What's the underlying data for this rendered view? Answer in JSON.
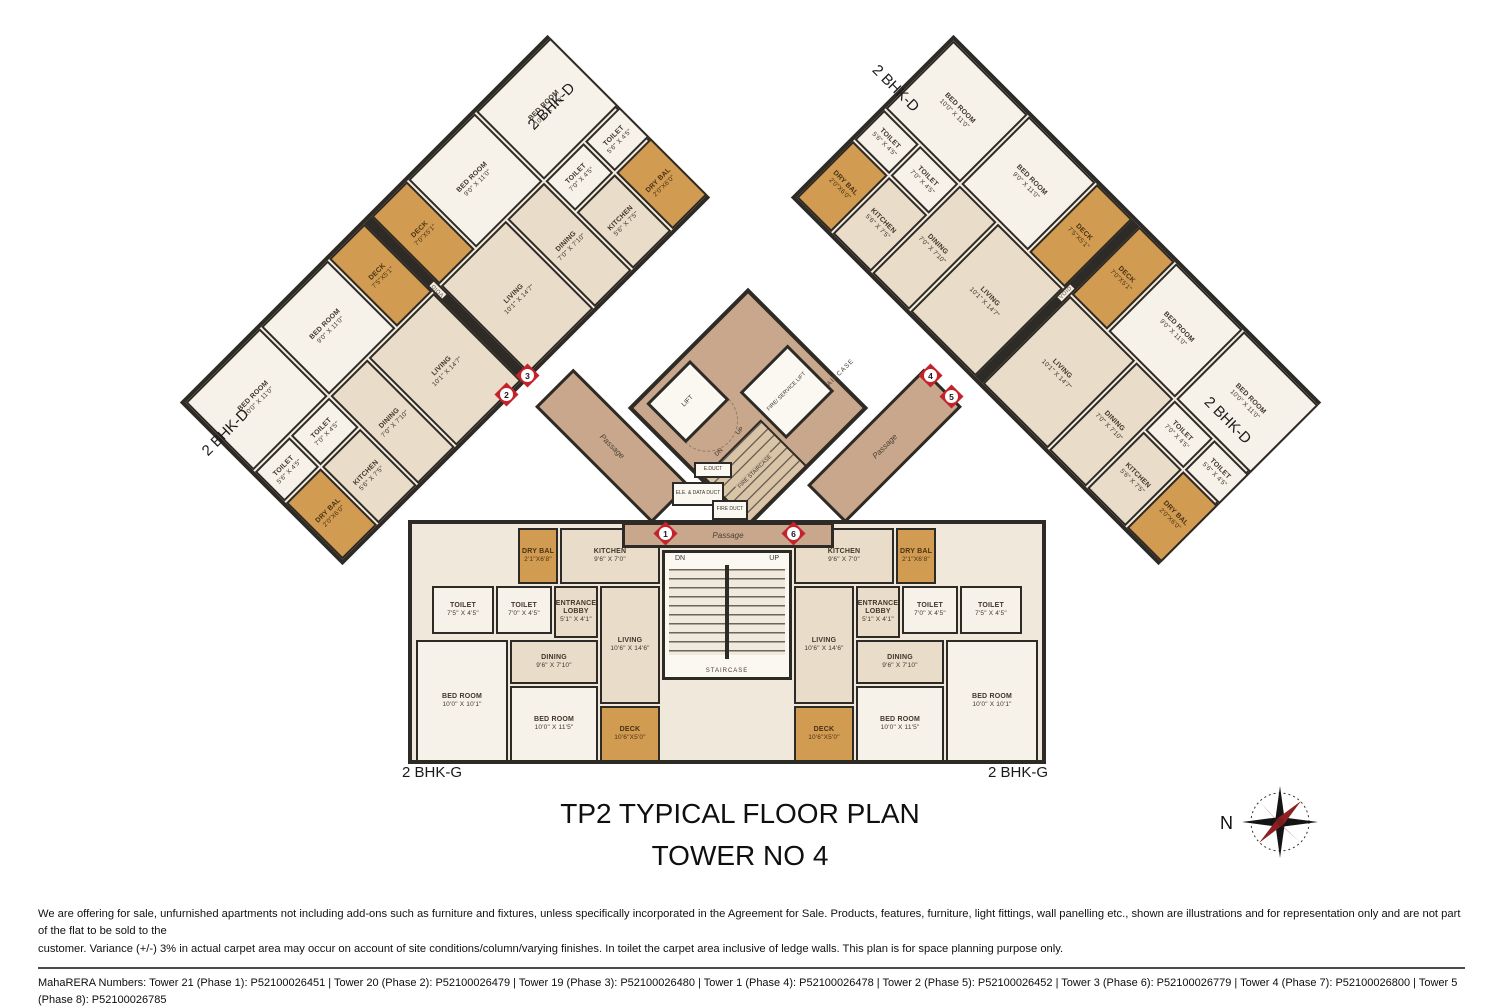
{
  "theme": {
    "wall": "#2e2a25",
    "floor": "#e9ddc9",
    "floor_light": "#f7f2e9",
    "deck": "#d19b52",
    "passage": "#c8a78c",
    "marker_red": "#c4232b"
  },
  "plan": {
    "title_line1": "TP2 TYPICAL FLOOR PLAN",
    "title_line2": "TOWER NO 4",
    "unit_label_d": "2 BHK-D",
    "unit_label_g": "2 BHK-G",
    "void_label": "VOID",
    "compass_label": "N"
  },
  "units": {
    "bhk_d": {
      "rooms": [
        {
          "key": "bedroom1",
          "name": "BED ROOM",
          "dims": "9'0\" X 11'0\""
        },
        {
          "key": "bedroom2",
          "name": "BED ROOM",
          "dims": "10'0\" X 11'0\""
        },
        {
          "key": "toilet1",
          "name": "TOILET",
          "dims": "7'0\" X 4'5\""
        },
        {
          "key": "toilet2",
          "name": "TOILET",
          "dims": "5'6\" X 4'5\""
        },
        {
          "key": "living",
          "name": "LIVING",
          "dims": "10'1\" X 14'7\""
        },
        {
          "key": "dining",
          "name": "DINING",
          "dims": "7'0\" X 7'10\""
        },
        {
          "key": "kitchen",
          "name": "KITCHEN",
          "dims": "5'6\" X 7'5\""
        },
        {
          "key": "deck",
          "name": "DECK",
          "dims": "7'0\"X5'1\""
        },
        {
          "key": "drybal",
          "name": "DRY BAL",
          "dims": "2'0\"X6'0\""
        }
      ],
      "deck_alt_dims": "7'5\"X5'1\""
    },
    "bhk_g": {
      "rooms": [
        {
          "key": "entrance",
          "name": "ENTRANCE LOBBY",
          "dims": "5'1\" X 4'1\""
        },
        {
          "key": "living",
          "name": "LIVING",
          "dims": "10'6\" X 14'6\""
        },
        {
          "key": "kitchen",
          "name": "KITCHEN",
          "dims": "9'6\" X 7'0\""
        },
        {
          "key": "drybal",
          "name": "DRY BAL",
          "dims": "2'1\"X6'8\""
        },
        {
          "key": "dining",
          "name": "DINING",
          "dims": "9'6\" X 7'10\""
        },
        {
          "key": "toilet1",
          "name": "TOILET",
          "dims": "7'5\" X 4'5\""
        },
        {
          "key": "toilet2",
          "name": "TOILET",
          "dims": "7'0\" X 4'5\""
        },
        {
          "key": "bedroom1",
          "name": "BED ROOM",
          "dims": "10'0\" X 11'5\""
        },
        {
          "key": "bedroom2",
          "name": "BED ROOM",
          "dims": "10'0\" X 10'1\""
        },
        {
          "key": "deck",
          "name": "DECK",
          "dims": "10'6\"X5'0\""
        }
      ]
    }
  },
  "core": {
    "lift": "LIFT",
    "service_lift": "FIRE/ SERVICE LIFT",
    "staircase": "STAIRCASE",
    "fire_staircase": "FIRE STAIRCASE",
    "passage": "Passage",
    "up": "UP",
    "dn": "DN",
    "ducts": [
      "E.DUCT",
      "ELE. & DATA DUCT",
      "FIRE DUCT"
    ]
  },
  "markers": [
    "1",
    "2",
    "3",
    "4",
    "5",
    "6"
  ],
  "footer": {
    "disclaimer_line1": "We are offering for sale, unfurnished apartments not including add-ons such as furniture and fixtures, unless specifically incorporated in the Agreement for Sale. Products, features, furniture, light fittings, wall panelling etc., shown are illustrations and for representation only and are not part of the flat to be sold to the",
    "disclaimer_line2": "customer. Variance (+/-) 3% in actual carpet area may occur on account of site conditions/column/varying finishes. In toilet the carpet area inclusive of ledge walls. This plan is for space planning purpose only.",
    "rera_line1": "MahaRERA Numbers: Tower 21 (Phase 1): P52100026451 | Tower 20 (Phase 2): P52100026479 | Tower 19 (Phase 3): P52100026480 | Tower 1 (Phase 4): P52100026478 | Tower 2 (Phase 5): P52100026452 | Tower 3 (Phase 6): P52100026779 | Tower 4 (Phase 7): P52100026800 | Tower 5 (Phase 8): P52100026785",
    "rera_line2": "Tower 17 (Phase 9): P52100026797 | Tower 18 (Phase 10): P52100026795 | Tower 6 (Phase 11) P52100028311 | Tower 8 (Phase 12) P52100028308. For details visit: https://maharera.mahaonline.gov.in"
  }
}
